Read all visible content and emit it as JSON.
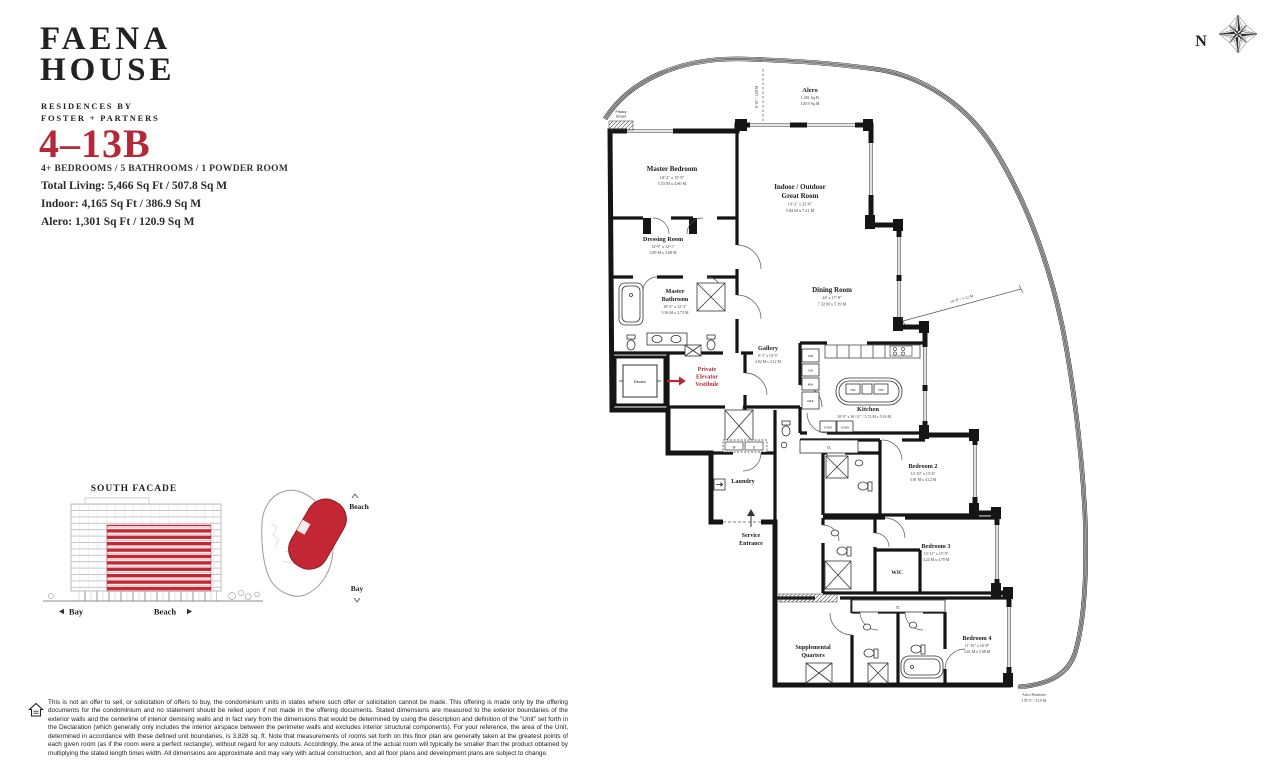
{
  "colors": {
    "accent": "#b42938",
    "facade_red": "#c22733",
    "wall": "#151515"
  },
  "brand": {
    "line1": "FAENA",
    "line2": "HOUSE",
    "sub1": "RESIDENCES BY",
    "sub2": "FOSTER + PARTNERS"
  },
  "compass": {
    "north": "N"
  },
  "unit": {
    "number": "4–13B",
    "config": "4+ BEDROOMS / 5 BATHROOMS / 1 POWDER ROOM",
    "total_living": "Total Living: 5,466 Sq Ft / 507.8 Sq M",
    "indoor": "Indoor: 4,165 Sq Ft / 386.9 Sq M",
    "alero": "Alero: 1,301 Sq Ft / 120.9 Sq M"
  },
  "plan": {
    "alero": {
      "name": "Alero",
      "sqft": "1,301 Sq Ft",
      "sqm": "120.9 Sq M"
    },
    "privacy1": "Privacy",
    "privacy2": "Screen",
    "master": {
      "name": "Master Bedroom",
      "ft": "18'-2\" x 15'-9\"",
      "m": "5.53 M x 4.80 M"
    },
    "great": {
      "name1": "Indoor / Outdoor",
      "name2": "Great Room",
      "ft": "19'-2\" x 23'-8\"",
      "m": "5.84 M x 7.21 M"
    },
    "dressing": {
      "name": "Dressing Room",
      "ft": "12'-9\" x 12'-1\"",
      "m": "3.89 M x 3.68 M"
    },
    "mbath": {
      "name1": "Master",
      "name2": "Bathroom",
      "ft": "18'-3\" x 12'-3\"",
      "m": "5.56 M x 3.73 M"
    },
    "dining": {
      "name": "Dining Room",
      "ft": "24' x 17'-8\"",
      "m": "7.32 M x 5.39 M"
    },
    "gallery": {
      "name": "Gallery",
      "ft": "9'-3\" x 10'-3\"",
      "m": "2.82 M x 3.12 M"
    },
    "vest": {
      "l1": "Private",
      "l2": "Elevator",
      "l3": "Vestibule"
    },
    "elevator": "Elevator",
    "kitchen": {
      "name": "Kitchen",
      "dims": "18'-9\" x 16'-11\" / 5.72 M x 5.16 M"
    },
    "laundry": "Laundry",
    "service": {
      "l1": "Service",
      "l2": "Entrance"
    },
    "bed2": {
      "name": "Bedroom 2",
      "ft": "12'-10\" x 13'-6\"",
      "m": "3.91 M x 4.12 M"
    },
    "bed3": {
      "name": "Bedroom 3",
      "ft": "13'-11\" x 15'-9\"",
      "m": "4.24 M x 4.79 M"
    },
    "wic": "WIC",
    "bed4": {
      "name": "Bedroom 4",
      "ft": "11'-10\" x 16'-8\"",
      "m": "3.61 M x 5.08 M"
    },
    "suppl": {
      "l1": "Supplemental",
      "l2": "Quarters"
    },
    "appl": {
      "wr": "WR",
      "cm": "CM",
      "mw": "MW",
      "ref": "REF",
      "dw": "DW",
      "oven": "OVEN",
      "w": "W",
      "d": "D",
      "cl": "CL"
    },
    "dims": {
      "alero_depth": "8'-10\" / 2.69 M",
      "side": "16'-9\" / 5.12 M",
      "perim1": "Alero Perimeter",
      "perim2": "170'-5\" / 51.9 M"
    }
  },
  "facade": {
    "title": "SOUTH FACADE",
    "bay": "Bay",
    "beach": "Beach"
  },
  "keyplan": {
    "beach": "Beach",
    "bay": "Bay"
  },
  "disclaimer": "This is not an offer to sell, or solicitation of offers to buy, the condominium units in states where such offer or solicitation cannot be made. This offering is made only by the offering documents for the condominium and no statement should be relied upon if not made in the offering documents. Stated dimensions are measured to the exterior boundaries of the exterior walls and the centerline of interior demising walls and in fact vary from the dimensions that would be determined by using the description and definition of the \"Unit\" set forth in the Declaration (which generally only includes the interior airspace between the perimeter walls and excludes interior structural components). For your reference, the area of the Unit, determined in accordance with these defined unit boundaries, is 3,828 sq. ft. Note that measurements of rooms set forth on this floor plan are generally taken at the greatest points of each given room (as if the room were a perfect rectangle), without regard for any cutouts. Accordingly, the area of the actual room will typically be smaller than the product obtained by multiplying the stated length times width. All dimensions are approximate and may vary with actual construction, and all floor plans and development plans are subject to change."
}
